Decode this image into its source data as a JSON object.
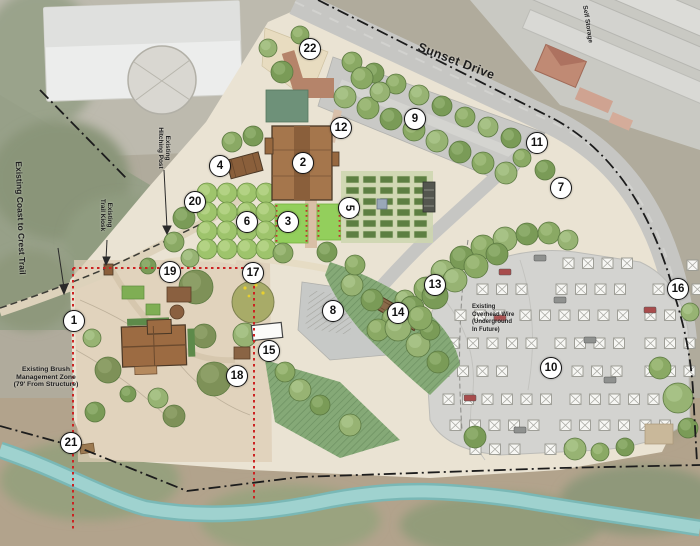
{
  "labels": {
    "sunset_drive": "Sunset Drive",
    "self_storage": "Self Storage",
    "coast_trail": "Existing Coast to Crest Trail",
    "trail_kiosk": [
      "Existing",
      "Trail Kiosk"
    ],
    "hitching_post": [
      "Existing",
      "Hitching Post"
    ],
    "brush_zone": [
      "Existing Brush",
      "Management Zone",
      "(79' From Structure)"
    ],
    "overhead_wire": [
      "Existing",
      "Overhead Wire",
      "(Underground",
      "In Future)"
    ]
  },
  "callouts": [
    {
      "n": "1",
      "x": 74,
      "y": 321
    },
    {
      "n": "2",
      "x": 303,
      "y": 163
    },
    {
      "n": "3",
      "x": 288,
      "y": 222
    },
    {
      "n": "4",
      "x": 220,
      "y": 166
    },
    {
      "n": "5",
      "x": 349,
      "y": 208,
      "rot": true
    },
    {
      "n": "6",
      "x": 247,
      "y": 222
    },
    {
      "n": "7",
      "x": 561,
      "y": 188
    },
    {
      "n": "8",
      "x": 333,
      "y": 311
    },
    {
      "n": "9",
      "x": 415,
      "y": 119
    },
    {
      "n": "10",
      "x": 551,
      "y": 368
    },
    {
      "n": "11",
      "x": 537,
      "y": 143
    },
    {
      "n": "12",
      "x": 341,
      "y": 128
    },
    {
      "n": "13",
      "x": 435,
      "y": 285
    },
    {
      "n": "14",
      "x": 398,
      "y": 313
    },
    {
      "n": "15",
      "x": 269,
      "y": 351
    },
    {
      "n": "16",
      "x": 678,
      "y": 289
    },
    {
      "n": "17",
      "x": 253,
      "y": 273
    },
    {
      "n": "18",
      "x": 237,
      "y": 376
    },
    {
      "n": "19",
      "x": 170,
      "y": 272
    },
    {
      "n": "20",
      "x": 195,
      "y": 202
    },
    {
      "n": "21",
      "x": 71,
      "y": 443
    },
    {
      "n": "22",
      "x": 310,
      "y": 49
    }
  ],
  "colors": {
    "callout_ring": "#141414",
    "red_boundary": "#cc2222",
    "creek": "#9fd2cf",
    "lawn": "#93cf5c",
    "barn": "#a5764c",
    "plan_ground": "#eae3d3",
    "road": "#c6c6c3"
  }
}
